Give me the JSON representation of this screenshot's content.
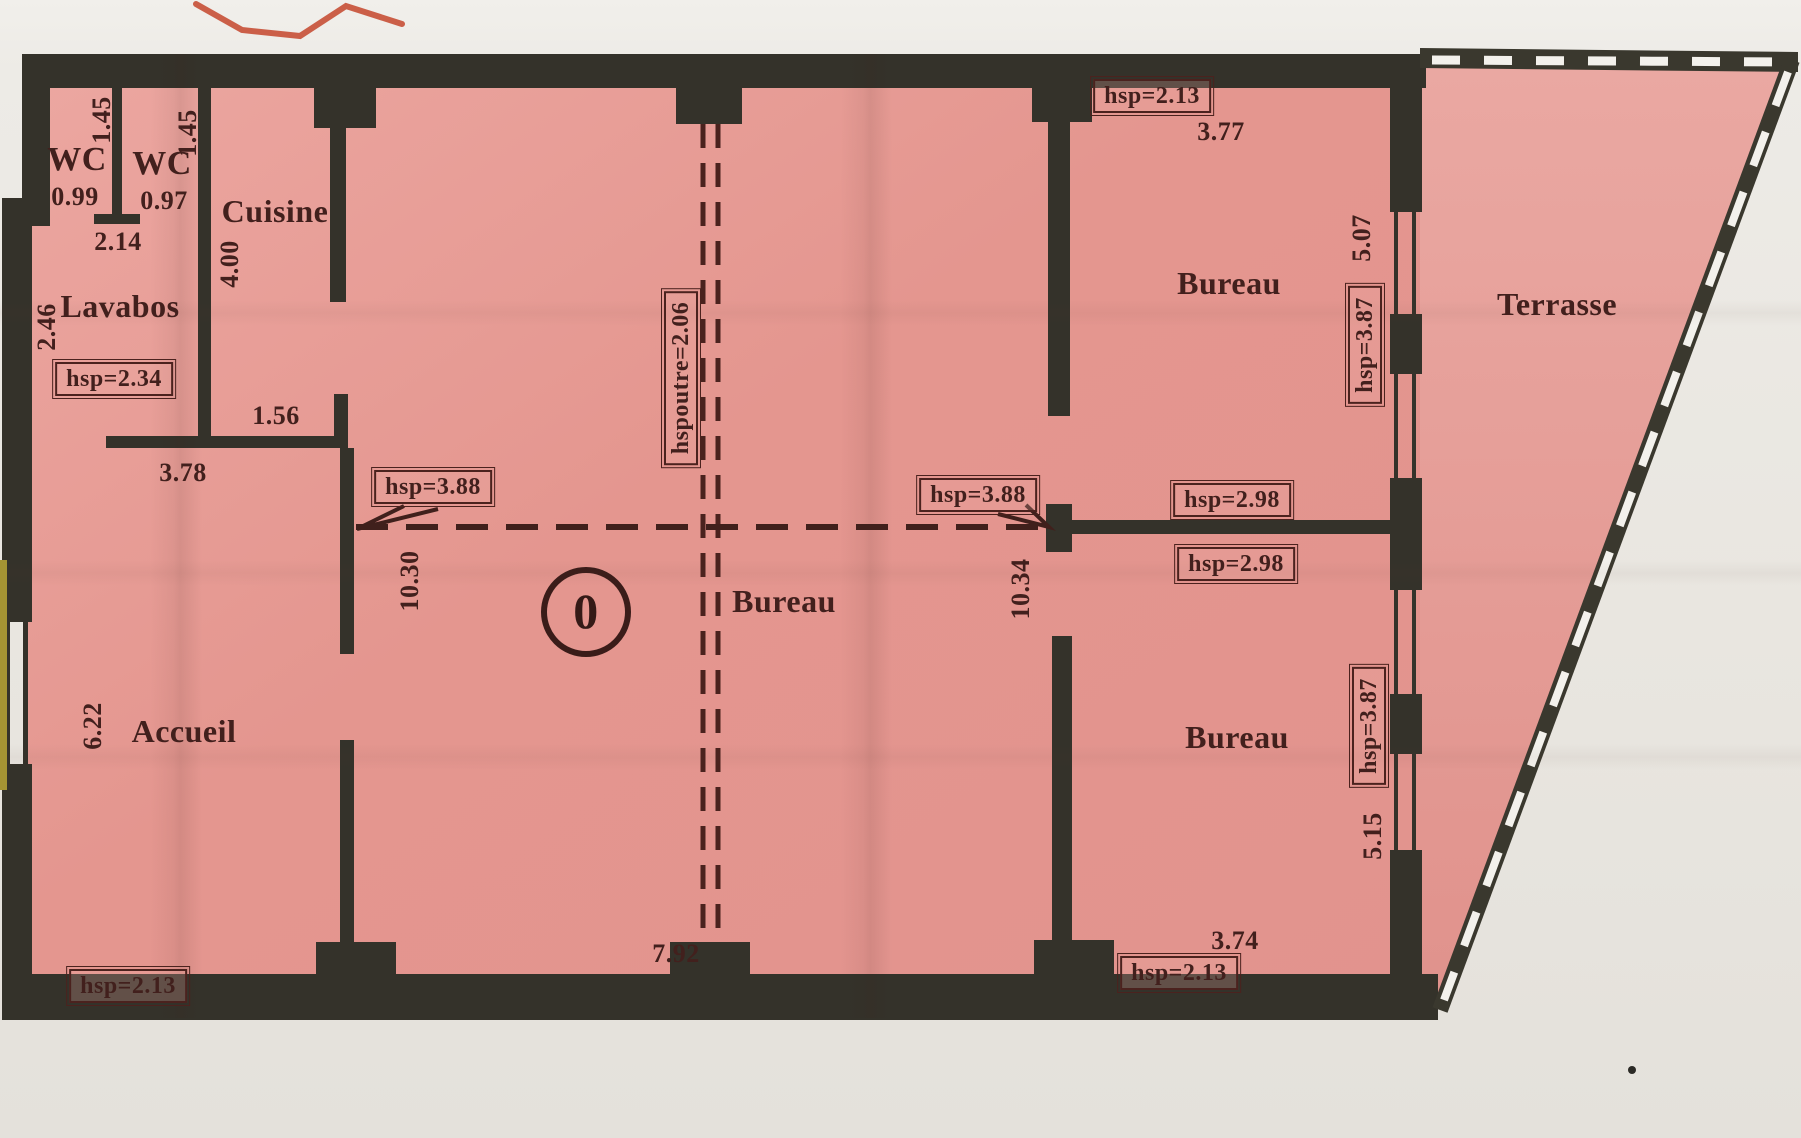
{
  "plan": {
    "title_note": "scanned floor plan, level 0",
    "rooms": {
      "wc_left": {
        "name": "WC",
        "depth": "1.45",
        "width": "0.99"
      },
      "wc_right": {
        "name": "WC",
        "depth": "1.45",
        "width": "0.97"
      },
      "wc_block_width": "2.14",
      "cuisine": {
        "name": "Cuisine",
        "depth": "4.00"
      },
      "lavabos": {
        "name": "Lavabos",
        "depth": "2.46",
        "ceiling": "hsp=2.34",
        "opening_width": "3.78",
        "wall_stub": "1.56"
      },
      "accueil": {
        "name": "Accueil",
        "width": "6.22",
        "ceiling": "hsp=2.13"
      },
      "open_space": {
        "name": "Bureau",
        "level_marker": "0",
        "left_depth": "10.30",
        "right_depth": "10.34",
        "bottom_width": "7.92",
        "ceiling_left": "hsp=3.88",
        "ceiling_right": "hsp=3.88",
        "beam_label": "hspoutre=2.06"
      },
      "bureau_top_right": {
        "name": "Bureau",
        "ceiling": "hsp=2.13",
        "top_width": "3.77",
        "window_width": "5.07",
        "window_height": "hsp=3.87",
        "wall_ceiling_above": "hsp=2.98",
        "wall_ceiling_below": "hsp=2.98"
      },
      "bureau_bottom_right": {
        "name": "Bureau",
        "ceiling": "hsp=2.13",
        "bottom_width": "3.74",
        "window_width": "5.15",
        "window_height": "hsp=3.87"
      },
      "terrasse": {
        "name": "Terrasse"
      }
    },
    "colors": {
      "paper": "#e9e6e0",
      "floor_pink": "#e59893",
      "terrace_pink": "#e7a39d",
      "wall_dark": "#34322a",
      "ink_maroon": "#42201d",
      "pen_red": "#c4452c",
      "edge_strip_yellow": "#a59433"
    }
  }
}
